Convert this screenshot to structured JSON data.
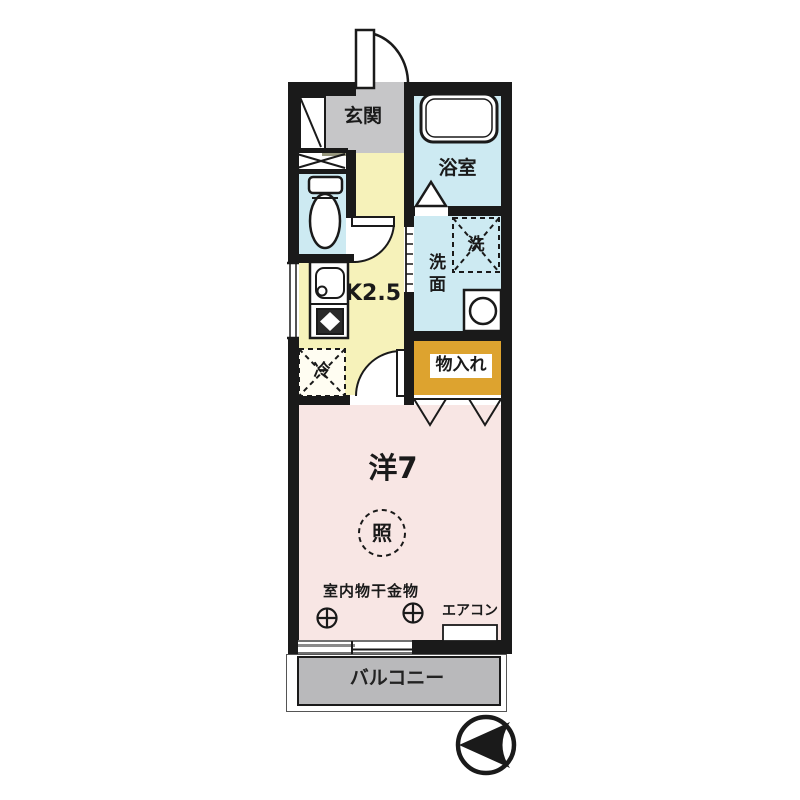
{
  "plan": {
    "type": "japanese-apartment-floor-plan",
    "rooms": {
      "entrance": {
        "label": "玄関"
      },
      "bath": {
        "label": "浴室"
      },
      "washroom": {
        "label": "洗面"
      },
      "washer_space": {
        "label": "洗"
      },
      "kitchen": {
        "label": "K2.5"
      },
      "fridge_space": {
        "label": "冷"
      },
      "closet": {
        "label": "物入れ"
      },
      "main_room": {
        "label": "洋7"
      },
      "balcony": {
        "label": "バルコニー"
      }
    },
    "annotations": {
      "ceiling_light": {
        "label": "照"
      },
      "indoor_laundry_hardware": {
        "label": "室内物干金物"
      },
      "air_conditioner": {
        "label": "エアコン"
      }
    },
    "symbols": [
      "north-arrow-icon",
      "door-swing-arc",
      "folding-door",
      "sliding-window",
      "bathtub",
      "toilet",
      "wash-basin",
      "kitchen-sink",
      "stove",
      "laundry-hook"
    ],
    "colors": {
      "walls": "#1a1a1a",
      "entrance_floor": "#c6c6c8",
      "wet_area_floor": "#cdeaf2",
      "kitchen_floor": "#f6f2ba",
      "closet_floor": "#dda32f",
      "main_room_floor": "#f8e6e4",
      "balcony_floor": "#b9b9bb"
    }
  }
}
